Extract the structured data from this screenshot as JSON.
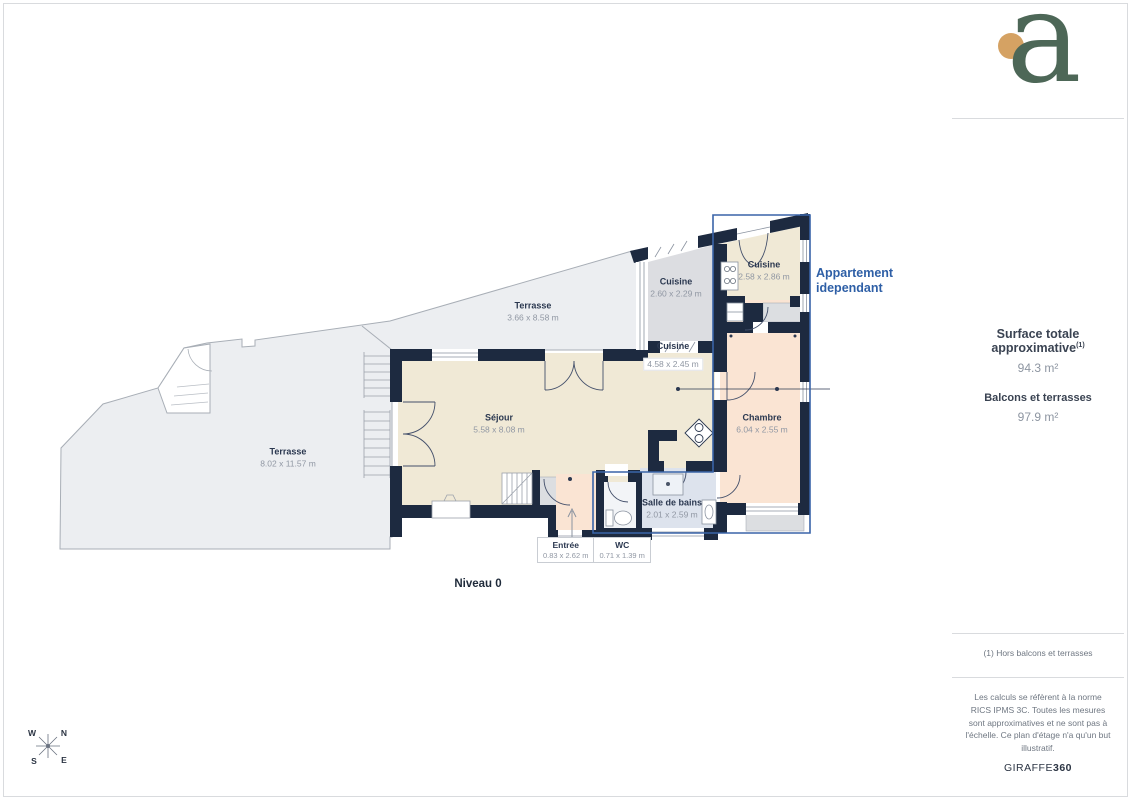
{
  "logo": {
    "letter": "a"
  },
  "sidebar": {
    "surface_title": "Surface totale approximative",
    "surface_sup": "(1)",
    "surface_value": "94.3 m²",
    "balcony_title": "Balcons et terrasses",
    "balcony_value": "97.9 m²",
    "footnote": "(1) Hors balcons et terrasses",
    "legal": "Les calculs se réfèrent à la norme RICS IPMS 3C. Toutes les mesures sont approximatives et ne sont pas à l'échelle. Ce plan d'étage n'a qu'un but illustratif.",
    "brand_name": "GIRAFFE",
    "brand_suffix": "360"
  },
  "plan": {
    "level_label": "Niveau 0",
    "annotation": {
      "line1": "Appartement",
      "line2": "idependant"
    },
    "compass": {
      "n": "N",
      "s": "S",
      "e": "E",
      "w": "W"
    },
    "rooms": [
      {
        "id": "terrasse-haute",
        "name": "Terrasse",
        "dims": "3.66 x 8.58 m"
      },
      {
        "id": "terrasse-basse",
        "name": "Terrasse",
        "dims": "8.02 x 11.57 m"
      },
      {
        "id": "sejour",
        "name": "Séjour",
        "dims": "5.58 x 8.08 m"
      },
      {
        "id": "cuisine-ouest",
        "name": "Cuisine",
        "dims": "2.60 x 2.29 m"
      },
      {
        "id": "cuisine-appartement",
        "name": "Cuisine",
        "dims": "2.58 x 2.86 m"
      },
      {
        "id": "cuisine-principale",
        "name": "Cuisine",
        "dims": "4.58 x 2.45 m"
      },
      {
        "id": "chambre",
        "name": "Chambre",
        "dims": "6.04 x 2.55 m"
      },
      {
        "id": "salle-de-bains",
        "name": "Salle de bains",
        "dims": "2.01 x 2.59 m"
      },
      {
        "id": "entree",
        "name": "Entrée",
        "dims": "0.83 x 2.62 m"
      },
      {
        "id": "wc",
        "name": "WC",
        "dims": "0.71 x 1.39 m"
      }
    ],
    "colors": {
      "accent_blue": "#3A64A8",
      "wall": "#1D2A40",
      "logo_green": "#4D6757",
      "logo_dot": "#D5A263"
    }
  }
}
